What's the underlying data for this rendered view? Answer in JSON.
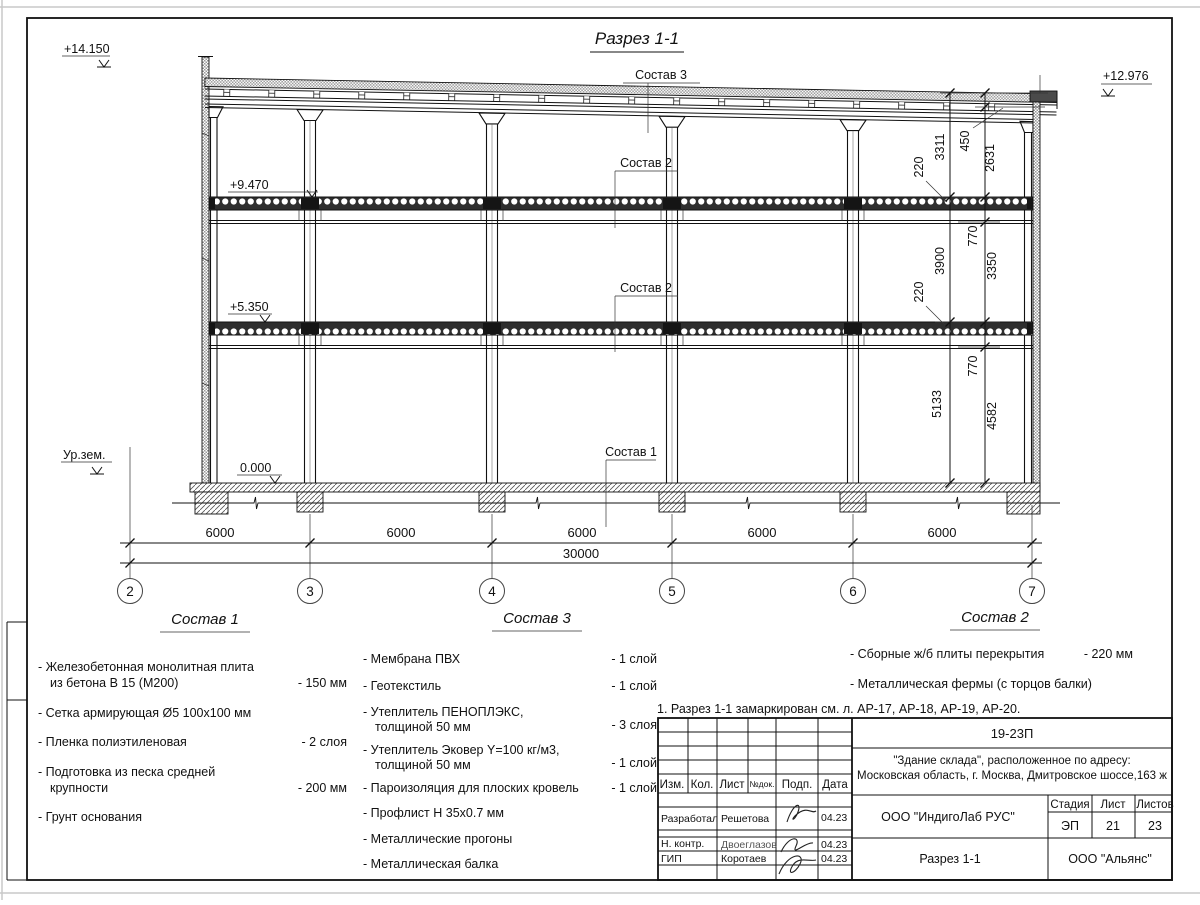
{
  "drawing": {
    "title": "Разрез 1-1",
    "elev": {
      "top_left": "+14.150",
      "top_right": "+12.976",
      "lvl3": "+9.470",
      "lvl2": "+5.350",
      "zero": "0.000",
      "ground": "Ур.зем."
    },
    "callouts": {
      "s1": "Состав 1",
      "s2": "Состав 2",
      "s3": "Состав 3"
    },
    "axes": [
      "2",
      "3",
      "4",
      "5",
      "6",
      "7"
    ],
    "dims": {
      "bays": [
        "6000",
        "6000",
        "6000",
        "6000",
        "6000"
      ],
      "total": "30000",
      "right_outer": [
        "3311",
        "3900",
        "5133"
      ],
      "right_inner": [
        "450",
        "2631",
        "770",
        "3350",
        "770",
        "4582"
      ],
      "slab": "220"
    }
  },
  "legend": {
    "s1": {
      "title": "Состав 1",
      "items": [
        {
          "l1": "- Железобетонная  монолитная плита",
          "l2": "из бетона В 15 (М200)",
          "val": "- 150 мм"
        },
        {
          "l1": "- Сетка армирующая Ø5 100х100 мм"
        },
        {
          "l1": "- Пленка полиэтиленовая",
          "val": "-  2 слоя"
        },
        {
          "l1": "- Подготовка из песка средней",
          "l2": "крупности",
          "val": "- 200 мм"
        },
        {
          "l1": "- Грунт основания"
        }
      ]
    },
    "s3": {
      "title": "Состав 3",
      "items": [
        {
          "l1": "- Мембрана ПВХ",
          "val": "- 1 слой"
        },
        {
          "l1": "- Геотекстиль",
          "val": "- 1 слой"
        },
        {
          "l1": "- Утеплитель ПЕНОПЛЭКС,",
          "l2": "толщиной 50 мм",
          "val": "- 3 слоя"
        },
        {
          "l1": "- Утеплитель Эковер Y=100 кг/м3,",
          "l2": "толщиной 50 мм",
          "val": "- 1 слой"
        },
        {
          "l1": "- Пароизоляция для плоских кровель",
          "val": "- 1 слой"
        },
        {
          "l1": "- Профлист Н 35х0.7 мм"
        },
        {
          "l1": "- Металлические прогоны"
        },
        {
          "l1": "- Металлическая балка"
        }
      ]
    },
    "s2": {
      "title": "Состав 2",
      "items": [
        {
          "l1": "- Сборные ж/б плиты перекрытия",
          "val": "- 220 мм"
        },
        {
          "l1": "- Металлическая фермы (с торцов балки)"
        }
      ]
    }
  },
  "note": "1. Разрез 1-1 замаркирован см. л. АР-17, АР-18, АР-19, АР-20.",
  "stamp": {
    "doc": "19-23П",
    "object1": "\"Здание склада\", расположенное по адресу:",
    "object2": "Московская область, г. Москва, Дмитровское шоссе,163 ж",
    "company": "ООО \"ИндигоЛаб РУС\"",
    "sheet_name": "Разрез 1-1",
    "org": "ООО \"Альянс\"",
    "cols": {
      "izm": "Изм.",
      "kol": "Кол.",
      "list": "Лист",
      "doc": "№док.",
      "sign": "Подп.",
      "date": "Дата"
    },
    "stage": {
      "label": "Стадия",
      "value": "ЭП"
    },
    "sheet": {
      "label": "Лист",
      "value": "21"
    },
    "sheets": {
      "label": "Листов",
      "value": "23"
    },
    "rows": [
      {
        "role": "Разработал",
        "name": "Решетова",
        "date": "04.23"
      },
      {
        "role": "Н. контр.",
        "name": "Двоеглазов",
        "date": "04.23"
      },
      {
        "role": "ГИП",
        "name": "Коротаев",
        "date": "04.23"
      }
    ]
  }
}
